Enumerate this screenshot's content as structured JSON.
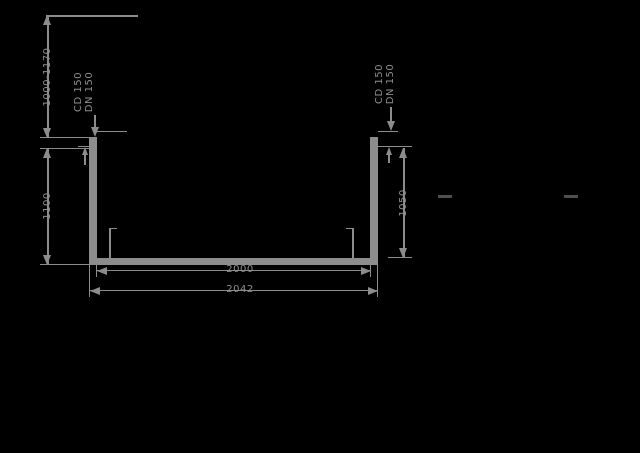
{
  "drawing": {
    "title": "channel cross-section technical drawing",
    "dimensions": {
      "depth_range": "1000-1170",
      "outer_height": "1100",
      "inner_depth": "1050",
      "inner_width": "2000",
      "outer_width": "2042"
    },
    "callouts": {
      "left": {
        "line1": "CD 150",
        "line2": "DN 150"
      },
      "right": {
        "line1": "CD 150",
        "line2": "DN 150"
      }
    },
    "colors": {
      "background": "#000000",
      "line": "#8c8c8c",
      "faint_mark": "#4f4f4f"
    }
  }
}
